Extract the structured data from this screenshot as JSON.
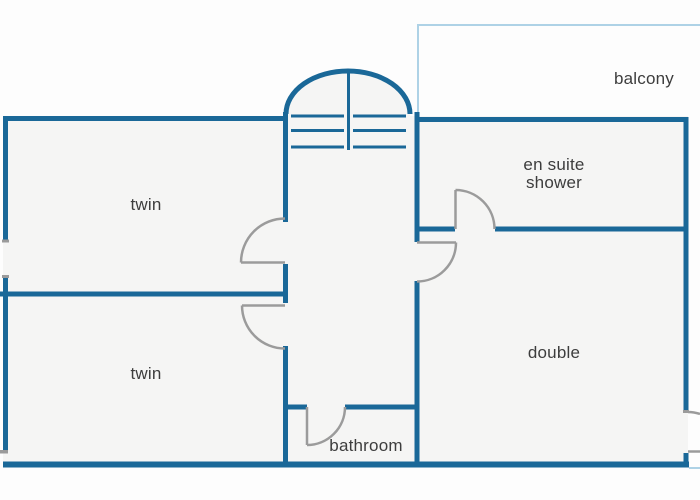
{
  "colors": {
    "wall": "#1a6898",
    "balcony_outline": "#aed2e6",
    "door": "#9b9b9b",
    "room_fill": "#f5f5f4",
    "background": "#fdfdfd",
    "label_text": "#3d3d3d"
  },
  "rooms": [
    {
      "id": "twin-top",
      "label": "twin"
    },
    {
      "id": "twin-bottom",
      "label": "twin"
    },
    {
      "id": "ensuite-shower",
      "label": "en suite shower"
    },
    {
      "id": "double",
      "label": "double"
    },
    {
      "id": "bathroom",
      "label": "bathroom"
    },
    {
      "id": "balcony",
      "label": "balcony"
    }
  ]
}
